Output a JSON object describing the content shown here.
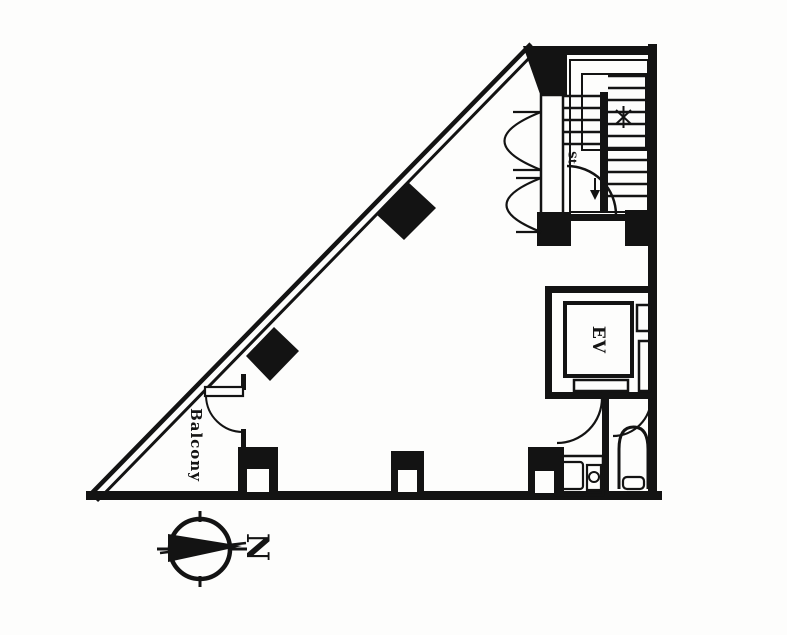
{
  "page": {
    "colors": {
      "ink": "#131313",
      "paper": "#fdfdfc"
    }
  },
  "floorplan": {
    "labels": {
      "balcony": "Balcony",
      "elevator": "EV",
      "stair": "St",
      "compass_north": "N"
    }
  }
}
